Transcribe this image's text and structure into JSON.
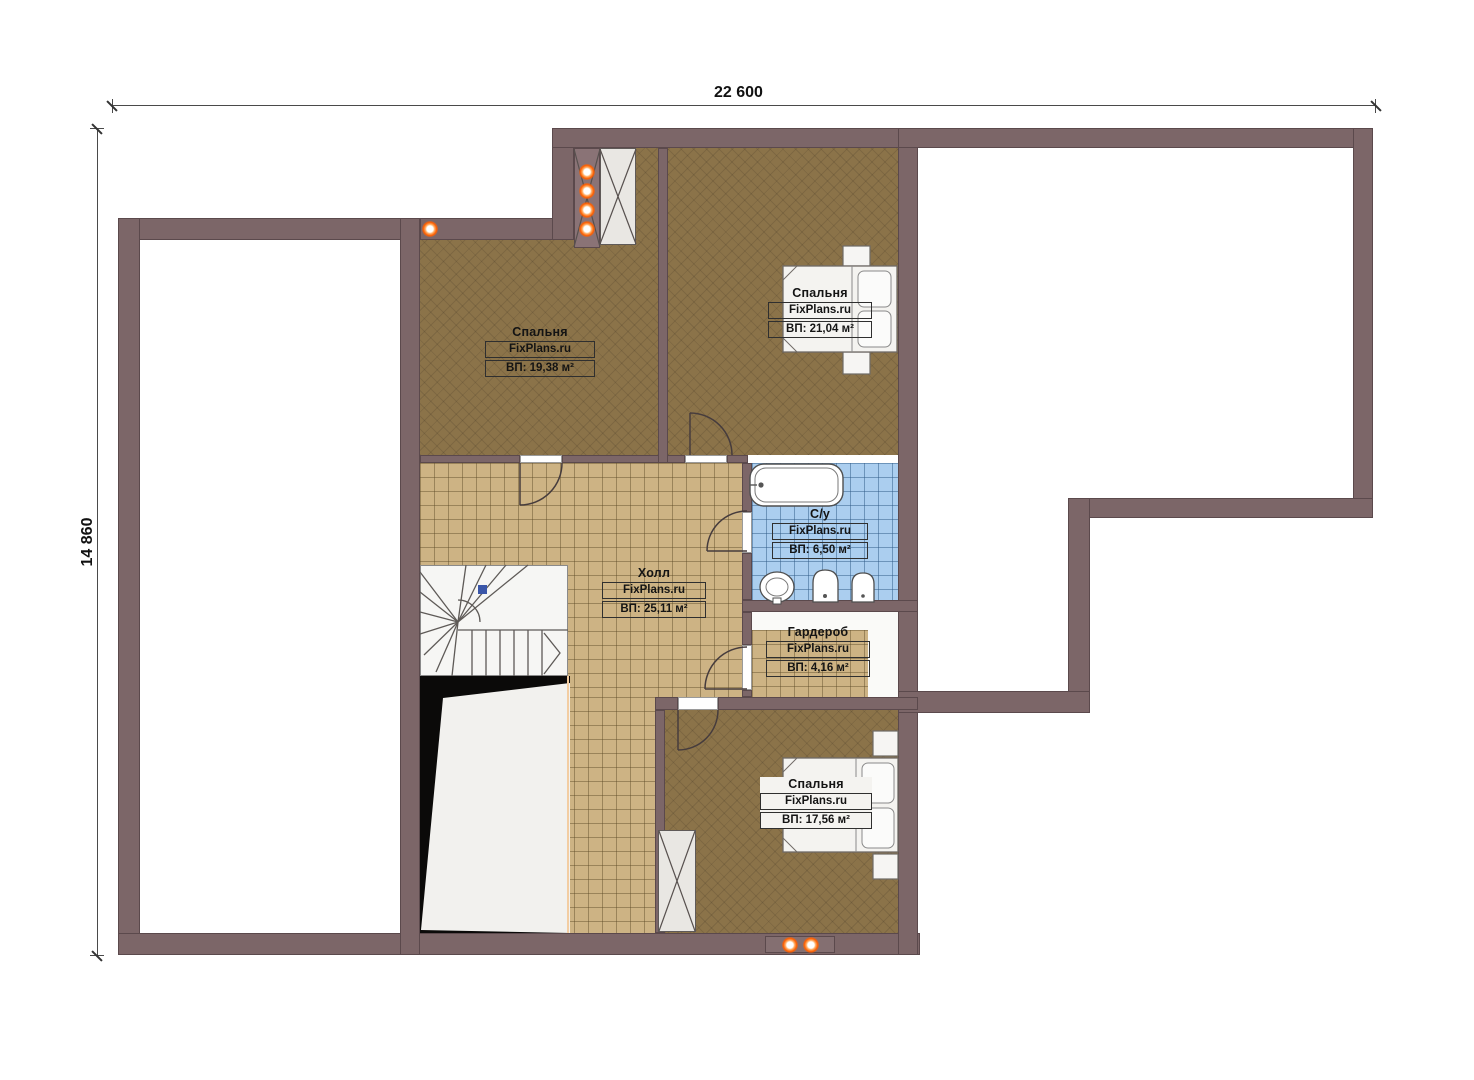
{
  "plan_title": "Second floor plan",
  "dimensions": {
    "width_label": "22 600",
    "height_label": "14 860"
  },
  "brand": "FixPlans.ru",
  "rooms": [
    {
      "name": "Спальня",
      "brand": "FixPlans.ru",
      "area": "ВП: 19,38 м²"
    },
    {
      "name": "Спальня",
      "brand": "FixPlans.ru",
      "area": "ВП: 21,04 м²"
    },
    {
      "name": "Холл",
      "brand": "FixPlans.ru",
      "area": "ВП: 25,11 м²"
    },
    {
      "name": "С/у",
      "brand": "FixPlans.ru",
      "area": "ВП: 6,50 м²"
    },
    {
      "name": "Гардероб",
      "brand": "FixPlans.ru",
      "area": "ВП: 4,16 м²"
    },
    {
      "name": "Спальня",
      "brand": "FixPlans.ru",
      "area": "ВП: 17,56 м²"
    }
  ],
  "colors": {
    "wall": "#7c6668",
    "wall_outline": "#5b494c",
    "bedroom_floor": "#8b7349",
    "hall_tile": "#cdb384",
    "bath_tile": "#abceef",
    "void": "#0b0a09",
    "light_dot": "#ff5f00",
    "stair_marker": "#3a56a8"
  },
  "icons": [
    "ceiling-light-icon",
    "ventilation-shaft-icon",
    "stair-direction-marker",
    "bathtub",
    "toilet",
    "washbasin",
    "bidet",
    "double-bed",
    "staircase",
    "door-arc"
  ]
}
